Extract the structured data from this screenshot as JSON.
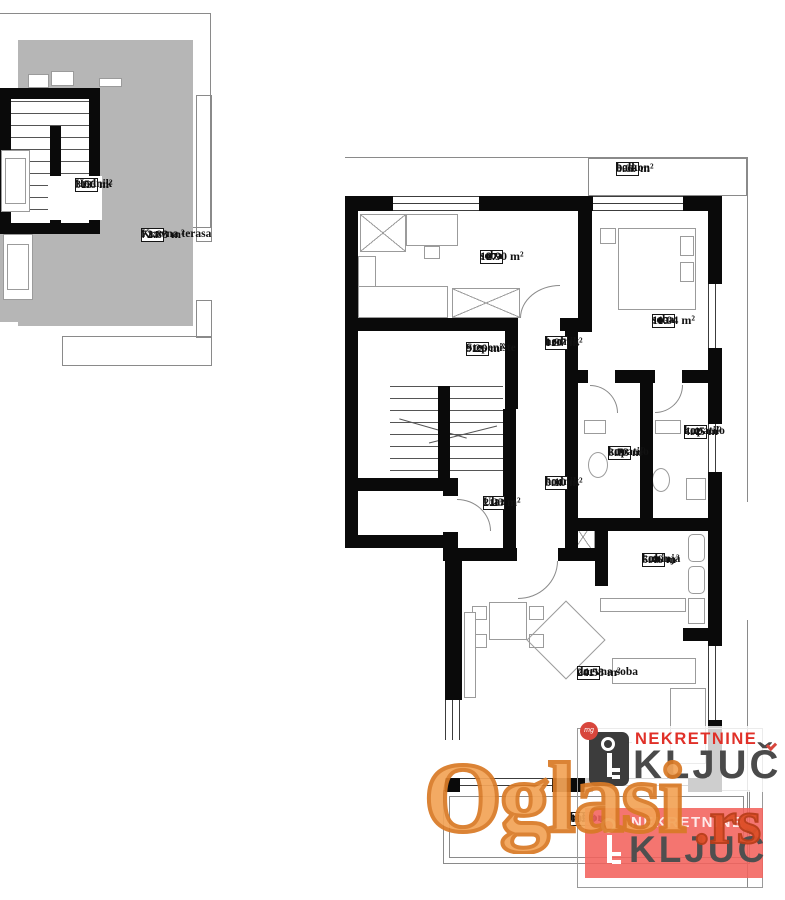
{
  "colors": {
    "wall": "#0a0a0a",
    "thin_line": "#8a8a8a",
    "furniture_line": "#9b9b9b",
    "terrace_gray": "#b6b6b6",
    "oglasi_fill": "#f3a458",
    "oglasi_stroke": "#d97a26",
    "rs_color": "#dd4f28",
    "brand_red": "#e03028",
    "brand_gray": "#4a4a4a",
    "logo_red_bg": "#f2625c"
  },
  "mini_plan": {
    "rooms": [
      {
        "number": "13",
        "name": "Hodnik",
        "area": "3.56 m²"
      },
      {
        "number": "14",
        "name": "Krovna terasa",
        "area": "72.88 m²"
      }
    ]
  },
  "main_plan": {
    "rooms": [
      {
        "number": "01",
        "name": "dnevna soba",
        "area": "24.58 m²"
      },
      {
        "number": "02",
        "name": "kupatilo",
        "area": "4.45 m²"
      },
      {
        "number": "03",
        "name": "soba",
        "area": "11.04 m²"
      },
      {
        "number": "04",
        "name": "hodnik",
        "area": "5.10 m²"
      },
      {
        "number": "05",
        "name": "balkon",
        "area": "11.00 m²"
      },
      {
        "number": "06",
        "name": "balkon",
        "area": "8.09 m²"
      },
      {
        "number": "07",
        "name": "soba",
        "area": "12.90 m²"
      },
      {
        "number": "08",
        "name": "kuhinja",
        "area": "5.46 m²"
      },
      {
        "number": "09",
        "name": "kupatilo",
        "area": "3.73 m²"
      },
      {
        "number": "10",
        "name": "hodnik",
        "area": "1.97 m²"
      },
      {
        "number": "11",
        "name": "Ulaz",
        "area": "2.23 m²"
      },
      {
        "number": "12",
        "name": "Stepenište",
        "area": "9.26 m²"
      }
    ]
  },
  "watermarks": {
    "oglasi": {
      "text": "Oglasi",
      "suffix": ".rs"
    },
    "logos": [
      {
        "brand": "NEKRETNINE",
        "name": "KLJUČ",
        "badge": "mg",
        "style": "light"
      },
      {
        "brand": "NEKRETNINE",
        "name": "KLJUČ",
        "style": "red"
      }
    ]
  }
}
